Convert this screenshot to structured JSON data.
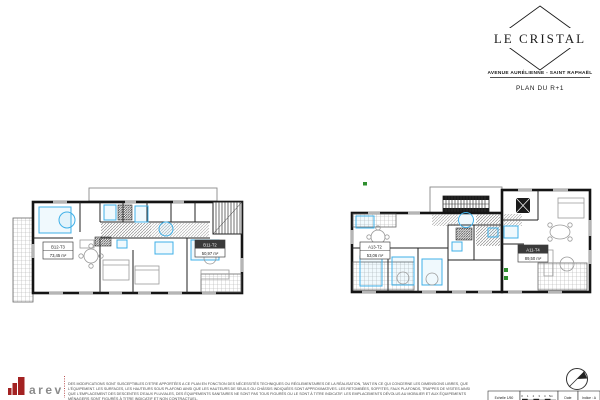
{
  "header": {
    "logo_title": "LE CRISTAL",
    "address": "AVENUE AURÉLIENNE - SAINT RAPHAËL",
    "plan_title": "PLAN DU R+1"
  },
  "plans": {
    "left": {
      "units": [
        {
          "code": "B12-T3",
          "area": "73,45 m²"
        },
        {
          "code": "B11-T2",
          "area": "50,97 m²"
        }
      ]
    },
    "right": {
      "units": [
        {
          "code": "A13-T2",
          "area": "53,06 m²"
        },
        {
          "code": "A11-T4",
          "area": "89,50 m²"
        }
      ]
    }
  },
  "footer": {
    "brand": "arev",
    "disclaimer_lines": [
      "DES MODIFICATIONS SONT SUSCEPTIBLES D'ETRE APPORTÉES A CE PLAN EN FONCTION DES NÉCESSITÉS TECHNIQUES OU RÉGLEMENTAIRES DE LA RÉALISATION, TANT EN CE QUI CONCERNE LES DIMENSIONS LIBRES, QUE",
      "L'ÉQUIPEMENT. LES SURFACES, LES HAUTEURS SOUS PLAFOND AINSI QUE LES HAUTEURS DE SEUILS OU CHÂSSIS INDIQUÉES SONT APPROXIMATIVES. LES RETOMBÉES, SOFFITES, FAUX PLAFONDS, TRAPPES DE VISITES AINSI",
      "QUE L'EMPLACEMENT DES DESCENTES D'EAUX PLUVIALES, DES ÉQUIPEMENTS SANITAIRES NE SONT PAS TOUS FIGURÉS OU LE SONT À TITRE INDICATIF. LES EMPLACEMENTS DÉVOLUS AU MOBILIER ET AUX ÉQUIPEMENTS",
      "MÉNAGERS SONT FIGURÉS À TITRE INDICATIF ET NON CONTRACTUEL."
    ],
    "scale": {
      "label": "Echelle 1/50",
      "ticks": [
        "0",
        "1",
        "2",
        "3",
        "4",
        "5m"
      ],
      "date_label": "Date",
      "indice_label": "Indice : A"
    }
  },
  "colors": {
    "accent_blue": "#3FB0E8",
    "wall_black": "#141414",
    "brand_red": "#A32222",
    "marker_green": "#2F8F2F"
  }
}
